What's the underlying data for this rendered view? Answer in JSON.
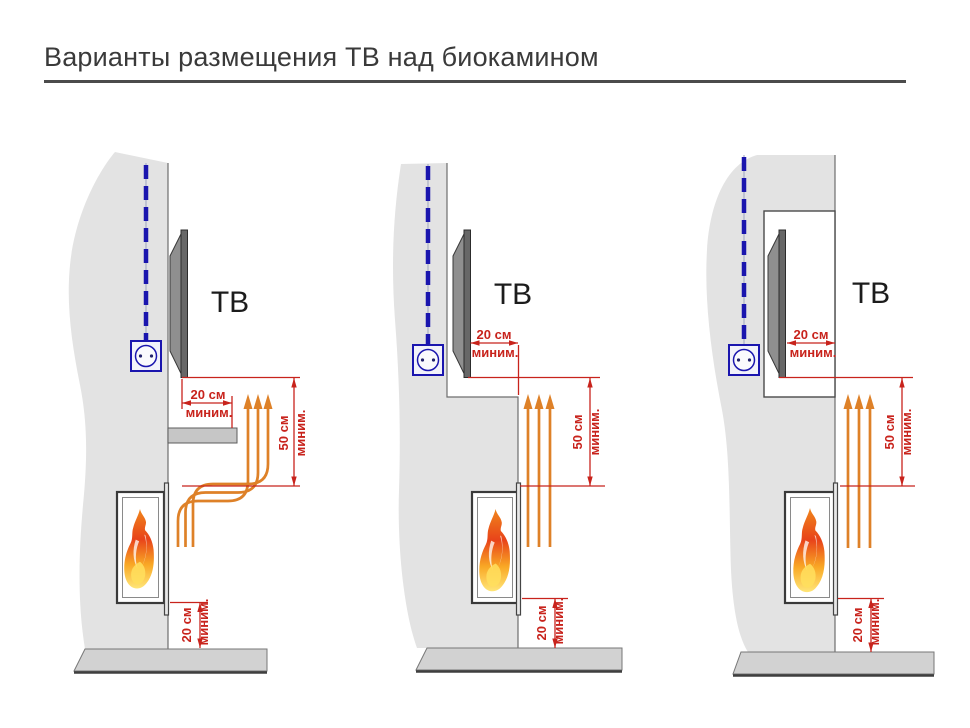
{
  "title": "Варианты размещения ТВ над биокамином",
  "diagrams": [
    {
      "tv_label": "ТВ",
      "front_clearance": {
        "value": "20 см",
        "qualifier": "миним."
      },
      "vertical_clearance": {
        "value": "50 см",
        "qualifier": "миним."
      },
      "floor_clearance": {
        "value": "20 см",
        "qualifier": "миним."
      }
    },
    {
      "tv_label": "ТВ",
      "front_clearance": {
        "value": "20 см",
        "qualifier": "миним."
      },
      "vertical_clearance": {
        "value": "50 см",
        "qualifier": "миним."
      },
      "floor_clearance": {
        "value": "20 см",
        "qualifier": "миним."
      }
    },
    {
      "tv_label": "ТВ",
      "front_clearance": {
        "value": "20 см",
        "qualifier": "миним."
      },
      "vertical_clearance": {
        "value": "50 см",
        "qualifier": "миним."
      },
      "floor_clearance": {
        "value": "20 см",
        "qualifier": "миним."
      }
    }
  ],
  "colors": {
    "wall": "#e3e3e3",
    "floor": "#d2d2d2",
    "floor_shadow": "#3f3f3f",
    "dimension_red": "#c8231c",
    "heat_orange": "#de8128",
    "cable_blue": "#1a15ae",
    "tv_back_gray": "#8f8f8f",
    "tv_screen_gray": "#676767",
    "flame_top": "#f0861c",
    "flame_mid": "#e8431a",
    "flame_bottom": "#ffe678"
  },
  "icons": {
    "outlet": "power-outlet-icon",
    "flame": "flame-icon",
    "heat": "heat-arrow-icon",
    "cable": "power-cable-icon"
  }
}
